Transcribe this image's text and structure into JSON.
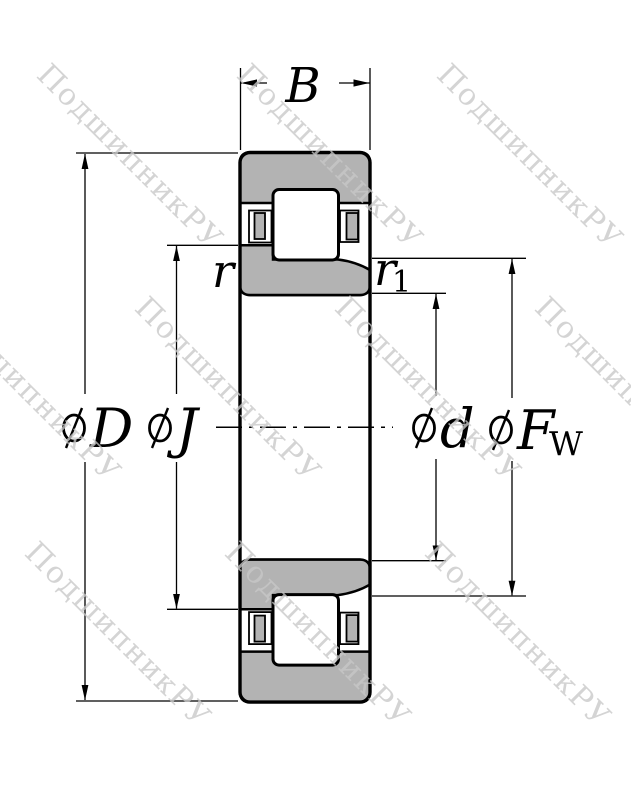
{
  "drawing": {
    "description_label": "bearing-cross-section-drawing"
  },
  "watermark": {
    "text": "ПодшипникРУ"
  },
  "dimension_labels": {
    "width": "B",
    "outer_diameter_letter": "D",
    "flange_diameter_letter": "J",
    "bore_diameter_letter": "d",
    "raceway_diameter_letter": "F",
    "raceway_diameter_subscript": "W",
    "outer_chamfer": "r",
    "inner_chamfer_letter": "r",
    "inner_chamfer_subscript": "1",
    "diameter_symbol": "⌀"
  },
  "colors": {
    "background": "#ffffff",
    "line": "#000000",
    "ring_fill": "#b3b3b3",
    "watermark": "#c8c8c8"
  }
}
